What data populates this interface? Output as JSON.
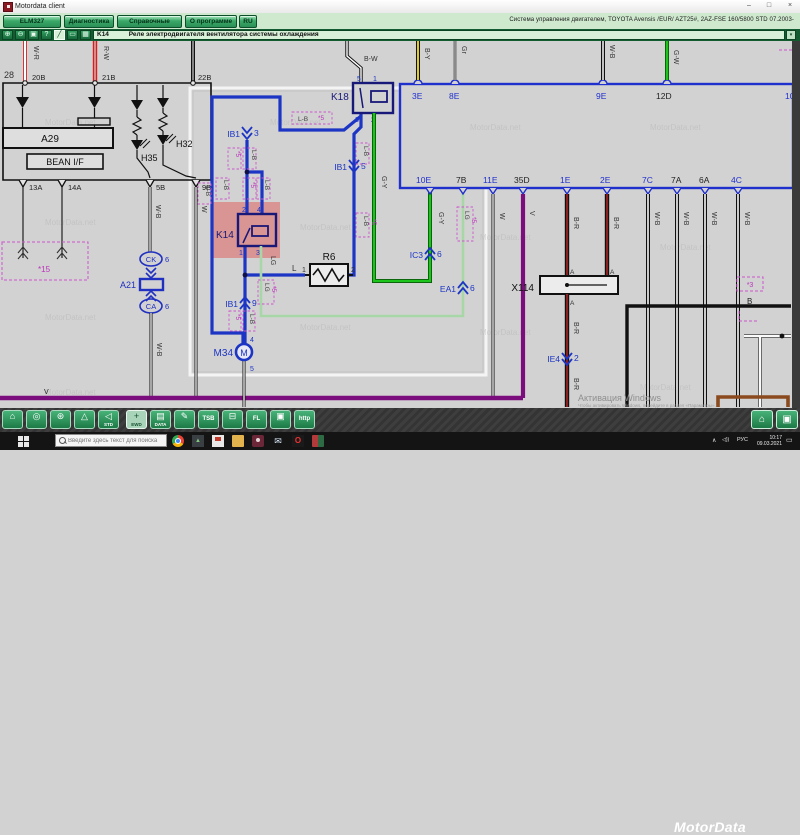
{
  "window": {
    "title": "Motordata client",
    "minimize": "–",
    "maximize": "□",
    "close": "×"
  },
  "menubar": {
    "buttons": [
      {
        "label": "ELM327"
      },
      {
        "label": "Диагностика"
      },
      {
        "label": "Справочные данные"
      },
      {
        "label": "О программе"
      },
      {
        "label": "RU"
      }
    ],
    "vehicle_info": "Система управления двигателем, TOYOTA  Avensis /EUR/  AZT25#,  2AZ-FSE 160/5800  STD  07.2003-"
  },
  "toolbar": {
    "icons": [
      {
        "name": "zoom-in-icon",
        "glyph": "⊕"
      },
      {
        "name": "zoom-out-icon",
        "glyph": "⊖"
      },
      {
        "name": "image-icon",
        "glyph": "▣"
      },
      {
        "name": "help-icon",
        "glyph": "?"
      },
      {
        "name": "pencil-icon",
        "glyph": "╱"
      },
      {
        "name": "pan-icon",
        "glyph": "▭"
      },
      {
        "name": "palette-icon",
        "glyph": "▦"
      }
    ],
    "code": "K14",
    "description": "Реле электродвигателя вентилятора системы охлаждения",
    "dropdown": "▾"
  },
  "diagram": {
    "watermark": "MotorData.net",
    "activation": {
      "line1": "Активация Windows",
      "line2": "Чтобы активировать Windows, перейдите в раздел «Параметры»."
    },
    "labels": {
      "n28": "28",
      "p20b": "20B",
      "p21b": "21B",
      "p22b": "22B",
      "wr": "W-R",
      "rw": "R-W",
      "a29": "A29",
      "bean": "BEAN I/F",
      "h35": "H35",
      "h32": "H32",
      "p13a": "13A",
      "p14a": "14A",
      "p5b": "5B",
      "p9b": "9B",
      "s15": "*15",
      "a21": "A21",
      "ck": "CK",
      "ca": "CA",
      "n6": "6",
      "wb": "W-B",
      "w": "W",
      "b": "B",
      "v": "V",
      "k14": "K14",
      "k18": "K18",
      "bw": "B-W",
      "lb": "L-B",
      "s5": "*5",
      "s3": "*3",
      "ib1": "IB1",
      "n1": "1",
      "n2": "2",
      "n3": "3",
      "n4": "4",
      "n5": "5",
      "n9": "9",
      "r6": "R6",
      "l": "L",
      "lg": "LG",
      "m34": "M34",
      "m": "M",
      "gy": "G-Y",
      "ic3": "IC3",
      "ea1": "EA1",
      "x114": "X114",
      "a": "A",
      "br": "B-R",
      "ie4": "IE4",
      "by": "B-Y",
      "gr": "Gr",
      "gw": "G-W",
      "p3e": "3E",
      "p8e": "8E",
      "p9e": "9E",
      "p12d": "12D",
      "p10": "10",
      "p10e": "10E",
      "p7b": "7B",
      "p11e": "11E",
      "p35d": "35D",
      "p1e": "1E",
      "p2e": "2E",
      "p7c": "7C",
      "p7a": "7A",
      "p6a": "6A",
      "p4c": "4C"
    }
  },
  "bottom_toolbar": {
    "icons": [
      {
        "name": "home-icon",
        "glyph": "⌂",
        "label": ""
      },
      {
        "name": "diagnostics-search-icon",
        "glyph": "◎",
        "label": ""
      },
      {
        "name": "settings-search-icon",
        "glyph": "⊛",
        "label": ""
      },
      {
        "name": "warning-triangle-icon",
        "glyph": "△",
        "label": ""
      },
      {
        "name": "audio-icon",
        "glyph": "◁",
        "label": "STD"
      },
      {
        "name": "ewd-icon",
        "glyph": "+",
        "label": "EWD"
      },
      {
        "name": "data-icon",
        "glyph": "▤",
        "label": "DATA"
      },
      {
        "name": "notes-icon",
        "glyph": "✎",
        "label": ""
      },
      {
        "name": "tsb-icon",
        "glyph": "",
        "label": "TSB"
      },
      {
        "name": "car-icon",
        "glyph": "⊟",
        "label": ""
      },
      {
        "name": "fuse-icon",
        "glyph": "",
        "label": "FL"
      },
      {
        "name": "book-icon",
        "glyph": "▣",
        "label": ""
      },
      {
        "name": "http-icon",
        "glyph": "",
        "label": "http"
      }
    ],
    "brand": "MotorData",
    "buttons": [
      {
        "name": "home-button",
        "glyph": "⌂"
      },
      {
        "name": "book-button",
        "glyph": "▣"
      }
    ]
  },
  "taskbar": {
    "search_placeholder": "Введите здесь текст для поиска",
    "apps": [
      "chrome-icon",
      "photos-icon",
      "store-icon",
      "folder-icon",
      "people-icon",
      "mail-icon",
      "opera-icon",
      "meet-icon"
    ],
    "tray": {
      "expand": "∧",
      "speaker": "◁))",
      "lang": "РУС",
      "time": "10:17",
      "date": "09.03.2021",
      "notif": "▭"
    }
  }
}
